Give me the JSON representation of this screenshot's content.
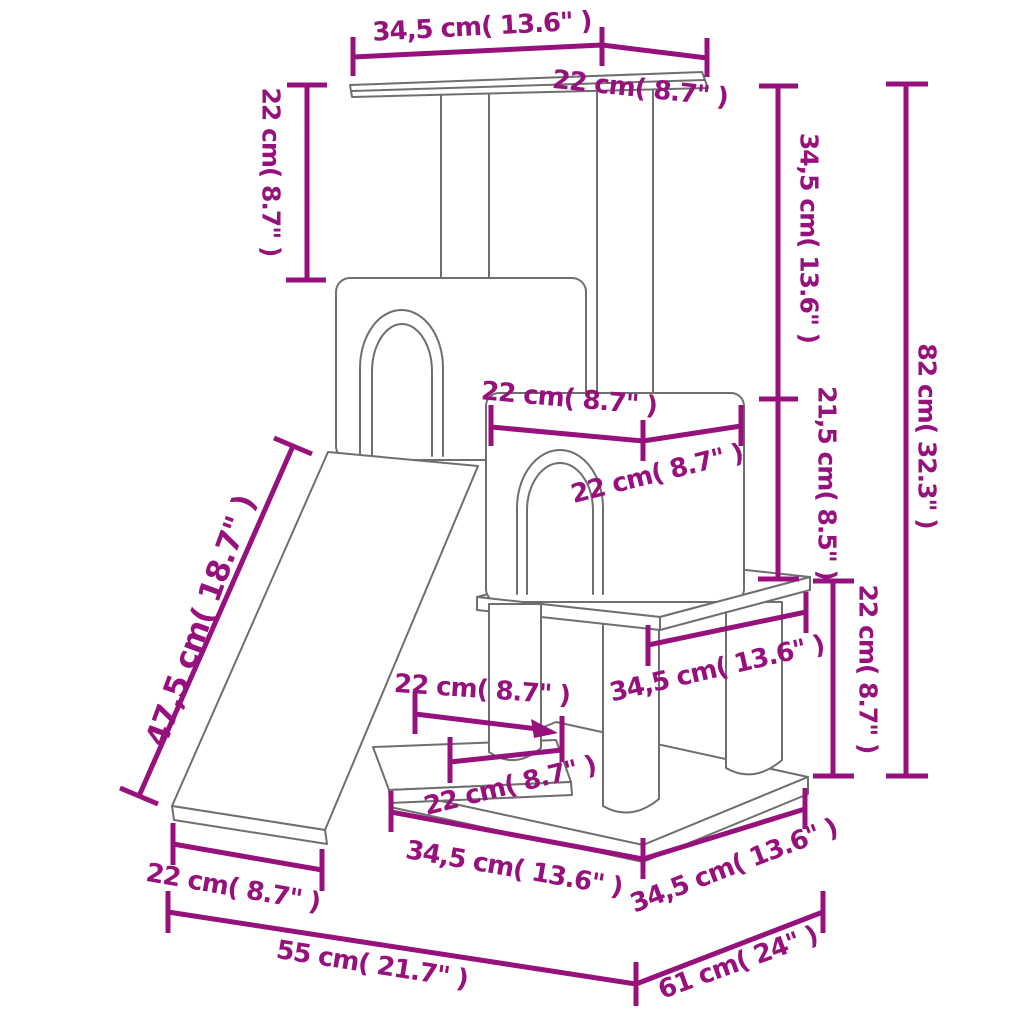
{
  "figure": {
    "kind": "product dimension line drawing",
    "subject": "cat tree with scratching posts, condos and ramp"
  },
  "colors": {
    "dimension_accent": "#97117d",
    "structure_outline": "#6f6f6f",
    "background": "#ffffff"
  },
  "units": {
    "primary": "cm",
    "secondary": "inch"
  },
  "dimensions": [
    {
      "id": "top-platform-width",
      "label": "34,5 cm( 13.6\" )",
      "cm": "34,5",
      "inch": "13.6"
    },
    {
      "id": "top-platform-depth",
      "label": "22 cm( 8.7\" )",
      "cm": "22",
      "inch": "8.7"
    },
    {
      "id": "top-pole-height",
      "label": "22 cm( 8.7\" )",
      "cm": "22",
      "inch": "8.7"
    },
    {
      "id": "upper-section-height",
      "label": "34,5 cm( 13.6\" )",
      "cm": "34,5",
      "inch": "13.6"
    },
    {
      "id": "condo-height",
      "label": "21,5 cm( 8.5\" )",
      "cm": "21,5",
      "inch": "8.5"
    },
    {
      "id": "total-height",
      "label": "82 cm( 32.3\" )",
      "cm": "82",
      "inch": "32.3"
    },
    {
      "id": "condo-width",
      "label": "22 cm( 8.7\" )",
      "cm": "22",
      "inch": "8.7"
    },
    {
      "id": "condo-depth",
      "label": "22 cm( 8.7\" )",
      "cm": "22",
      "inch": "8.7"
    },
    {
      "id": "lower-section-height",
      "label": "22 cm( 8.7\" )",
      "cm": "22",
      "inch": "8.7"
    },
    {
      "id": "mid-platform-width",
      "label": "34,5 cm( 13.6\" )",
      "cm": "34,5",
      "inch": "13.6"
    },
    {
      "id": "post-inset",
      "label": "22 cm( 8.7\" )",
      "cm": "22",
      "inch": "8.7"
    },
    {
      "id": "low-platform-width",
      "label": "22 cm( 8.7\" )",
      "cm": "22",
      "inch": "8.7"
    },
    {
      "id": "base-width",
      "label": "34,5 cm( 13.6\" )",
      "cm": "34,5",
      "inch": "13.6"
    },
    {
      "id": "base-depth",
      "label": "34,5 cm( 13.6\" )",
      "cm": "34,5",
      "inch": "13.6"
    },
    {
      "id": "ramp-length",
      "label": "47,5 cm( 18.7\" )",
      "cm": "47,5",
      "inch": "18.7"
    },
    {
      "id": "ramp-floor-width",
      "label": "22 cm( 8.7\" )",
      "cm": "22",
      "inch": "8.7"
    },
    {
      "id": "floor-width",
      "label": "55 cm( 21.7\" )",
      "cm": "55",
      "inch": "21.7"
    },
    {
      "id": "floor-depth",
      "label": "61 cm( 24\" )",
      "cm": "61",
      "inch": "24"
    }
  ]
}
